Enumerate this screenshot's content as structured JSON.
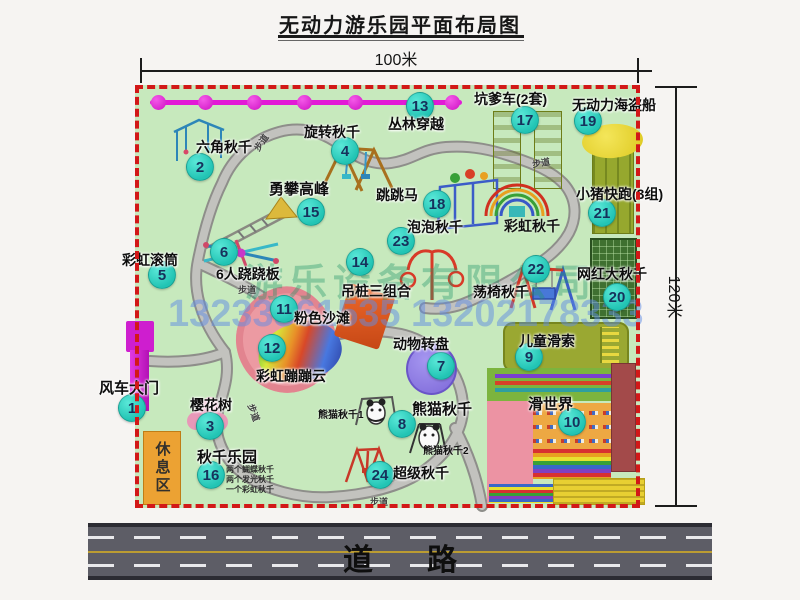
{
  "title": "无动力游乐园平面布局图",
  "dimensions": {
    "width": "100米",
    "height": "120米"
  },
  "road": {
    "label": "道路"
  },
  "watermark": {
    "company": "游乐设备有限公司",
    "phone": "13233861535 13202178333"
  },
  "map": {
    "rest_area_label": "休息区",
    "swing_notes": [
      "两个蝴蝶秋千",
      "两个发光秋千",
      "一个彩虹秋千"
    ],
    "pois": [
      {
        "num": "1",
        "label": "风车大门",
        "bx": 131,
        "by": 407,
        "lx": 99,
        "ly": 377,
        "fs": 15
      },
      {
        "num": "2",
        "label": "六角秋千",
        "bx": 199,
        "by": 166,
        "lx": 196,
        "ly": 137
      },
      {
        "num": "3",
        "label": "樱花树",
        "bx": 209,
        "by": 425,
        "lx": 190,
        "ly": 395
      },
      {
        "num": "4",
        "label": "旋转秋千",
        "bx": 344,
        "by": 150,
        "lx": 304,
        "ly": 122
      },
      {
        "num": "5",
        "label": "彩虹滚筒",
        "bx": 161,
        "by": 274,
        "lx": 122,
        "ly": 250
      },
      {
        "num": "6",
        "label": "6人跷跷板",
        "bx": 223,
        "by": 251,
        "lx": 216,
        "ly": 264
      },
      {
        "num": "7",
        "label": "动物转盘",
        "bx": 440,
        "by": 365,
        "lx": 393,
        "ly": 334
      },
      {
        "num": "8",
        "label": "熊猫秋千",
        "bx": 401,
        "by": 423,
        "lx": 412,
        "ly": 398,
        "fs": 15
      },
      {
        "num": "9",
        "label": "儿童滑索",
        "bx": 528,
        "by": 356,
        "lx": 519,
        "ly": 331
      },
      {
        "num": "10",
        "label": "滑世界",
        "bx": 571,
        "by": 421,
        "lx": 528,
        "ly": 393,
        "fs": 15
      },
      {
        "num": "11",
        "label": "粉色沙滩",
        "bx": 283,
        "by": 308,
        "lx": 294,
        "ly": 308
      },
      {
        "num": "12",
        "label": "彩虹蹦蹦云",
        "bx": 271,
        "by": 347,
        "lx": 256,
        "ly": 366
      },
      {
        "num": "13",
        "label": "丛林穿越",
        "bx": 419,
        "by": 105,
        "lx": 388,
        "ly": 114
      },
      {
        "num": "14",
        "label": "吊桩三组合",
        "bx": 359,
        "by": 261,
        "lx": 341,
        "ly": 281
      },
      {
        "num": "15",
        "label": "勇攀高峰",
        "bx": 310,
        "by": 211,
        "lx": 269,
        "ly": 178,
        "fs": 15
      },
      {
        "num": "16",
        "label": "秋千乐园",
        "bx": 210,
        "by": 474,
        "lx": 197,
        "ly": 446,
        "fs": 15
      },
      {
        "num": "17",
        "label": "坑爹车(2套)",
        "bx": 524,
        "by": 119,
        "lx": 474,
        "ly": 89
      },
      {
        "num": "18",
        "label": "跳跳马",
        "bx": 436,
        "by": 203,
        "lx": 376,
        "ly": 185
      },
      {
        "num": "19",
        "label": "无动力海盗船",
        "bx": 587,
        "by": 120,
        "lx": 572,
        "ly": 95
      },
      {
        "num": "20",
        "label": "网红大秋千",
        "bx": 616,
        "by": 296,
        "lx": 577,
        "ly": 264
      },
      {
        "num": "21",
        "label": "小猪快跑(3组)",
        "bx": 601,
        "by": 212,
        "lx": 576,
        "ly": 184
      },
      {
        "num": "22",
        "label": "荡椅秋千",
        "bx": 535,
        "by": 268,
        "lx": 473,
        "ly": 282
      },
      {
        "num": "23",
        "label": "泡泡秋千",
        "bx": 400,
        "by": 240,
        "lx": 407,
        "ly": 217
      },
      {
        "num": "24",
        "label": "超级秋千",
        "bx": 379,
        "by": 474,
        "lx": 393,
        "ly": 463
      }
    ],
    "labels": [
      {
        "text": "彩虹秋千",
        "x": 504,
        "y": 216,
        "size": 14,
        "rot": 0
      },
      {
        "text": "熊猫秋千1",
        "x": 318,
        "y": 406,
        "size": 10,
        "rot": 0
      },
      {
        "text": "熊猫秋千2",
        "x": 423,
        "y": 442,
        "size": 10,
        "rot": 0
      },
      {
        "text": "步道",
        "x": 252,
        "y": 136,
        "size": 9,
        "rot": -55
      },
      {
        "text": "步道",
        "x": 532,
        "y": 156,
        "size": 9,
        "rot": -10
      },
      {
        "text": "步道",
        "x": 238,
        "y": 283,
        "size": 9,
        "rot": 0
      },
      {
        "text": "步道",
        "x": 245,
        "y": 406,
        "size": 9,
        "rot": 70
      },
      {
        "text": "步道",
        "x": 370,
        "y": 495,
        "size": 9,
        "rot": 0
      }
    ]
  }
}
